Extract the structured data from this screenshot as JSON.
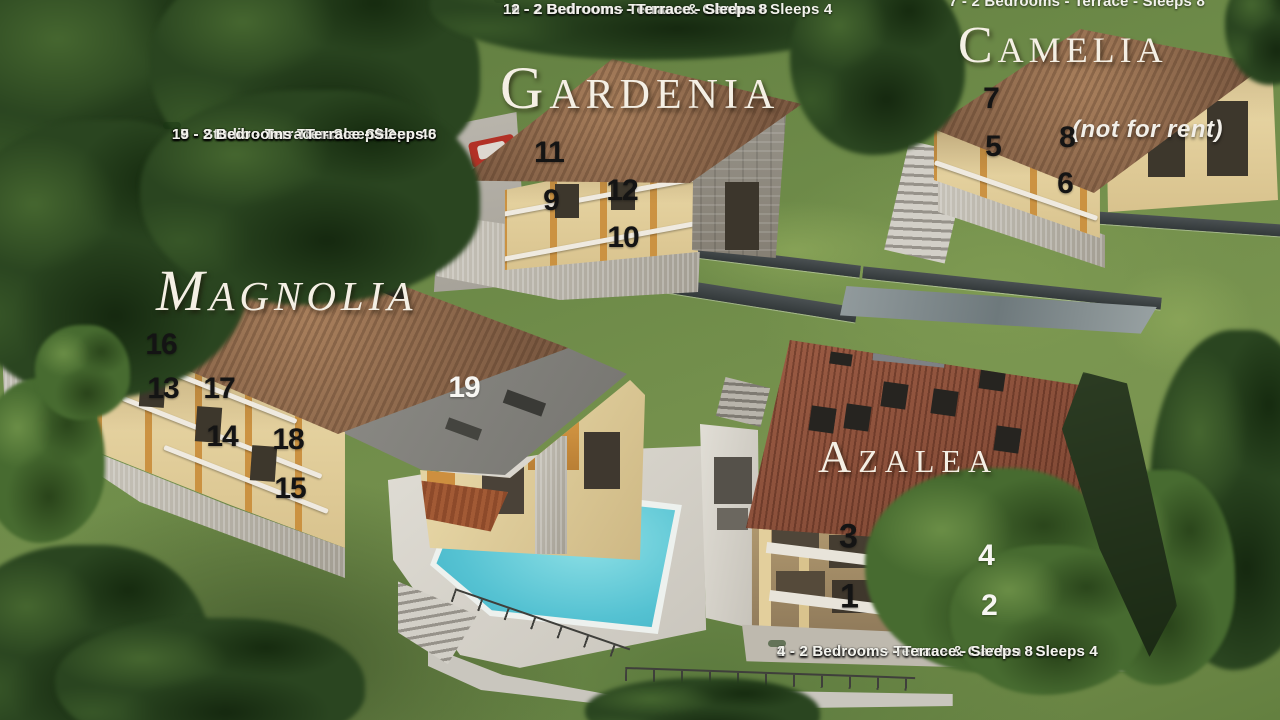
{
  "title": "Residence aerial site plan with apartment key",
  "palette": {
    "legend_text": "#f2f2ec",
    "marker_dark": "#141414",
    "marker_light": "#f7f6f2",
    "grass": "#6b8748",
    "trees": "#2a4520",
    "roof_brown": "#8a654c",
    "roof_terracotta": "#8f4f3a",
    "wall_cream": "#e7d6a4",
    "pool_water": "#57c3d2",
    "deck": "#d6d3cb",
    "stone_wall": "#9a958b"
  },
  "buildings": {
    "gardenia": {
      "name": "Gardenia",
      "legend": [
        "10 - 1 Bedroom - Terrace & Garden - Sleeps 4",
        "11 - 2 Bedrooms - Terrace - Sleeps 8",
        "12 - 2 Bedrooms - Terrace - Sleeps 8"
      ]
    },
    "camelia": {
      "name": "Camelia",
      "note": "(not for rent)",
      "legend": [
        "7 - 2 Bedrooms - Terrace - Sleeps 8"
      ]
    },
    "magnolia": {
      "name": "Magnolia",
      "legend": [
        "13 - 1 Bedroom - Terrace - Sleeps 4",
        "14 - 1 Bedroom - Terrace - Sleeps 4",
        "15 - 2 Bedrooms - Terrace - Sleeps 6",
        "16 - 2 Bedrooms - Terrace - Sleeps 8",
        "17 - 2 Bedrooms - Terrace - Sleeps 8",
        "18 - Studio - Terrace - Sleeps 2",
        "19 - 2 Bedrooms - Terrace - Sleeps 6"
      ]
    },
    "azalea": {
      "name": "Azalea",
      "legend": [
        "1 - 1 Bedroom - Terrace & Garden - Sleeps 4",
        "2 - 1 Bedroom - Terrace & Garden - Sleeps 4",
        "3 - 2 Bedrooms - Terrace - Sleeps 8",
        "4 - 2 Bedrooms - Terrace - Sleeps 8"
      ]
    }
  },
  "unit_markers": [
    {
      "label": "11",
      "building": "gardenia",
      "x": 549,
      "y": 153,
      "color": "#141414"
    },
    {
      "label": "9",
      "building": "gardenia",
      "x": 551,
      "y": 201,
      "color": "#141414"
    },
    {
      "label": "12",
      "building": "gardenia",
      "x": 622,
      "y": 191,
      "color": "#141414"
    },
    {
      "label": "10",
      "building": "gardenia",
      "x": 623,
      "y": 238,
      "color": "#141414"
    },
    {
      "label": "7",
      "building": "camelia",
      "x": 991,
      "y": 99,
      "color": "#141414"
    },
    {
      "label": "5",
      "building": "camelia",
      "x": 993,
      "y": 147,
      "color": "#141414"
    },
    {
      "label": "8",
      "building": "camelia",
      "x": 1067,
      "y": 138,
      "color": "#141414"
    },
    {
      "label": "6",
      "building": "camelia",
      "x": 1065,
      "y": 184,
      "color": "#141414"
    },
    {
      "label": "16",
      "building": "magnolia",
      "x": 161,
      "y": 345,
      "color": "#141414"
    },
    {
      "label": "13",
      "building": "magnolia",
      "x": 163,
      "y": 389,
      "color": "#141414"
    },
    {
      "label": "17",
      "building": "magnolia",
      "x": 219,
      "y": 389,
      "color": "#141414"
    },
    {
      "label": "14",
      "building": "magnolia",
      "x": 222,
      "y": 437,
      "color": "#141414"
    },
    {
      "label": "18",
      "building": "magnolia",
      "x": 288,
      "y": 440,
      "color": "#141414"
    },
    {
      "label": "15",
      "building": "magnolia",
      "x": 290,
      "y": 489,
      "color": "#141414"
    },
    {
      "label": "19",
      "building": "magnolia",
      "x": 464,
      "y": 388,
      "color": "#f7f6f2"
    },
    {
      "label": "3",
      "building": "azalea",
      "x": 848,
      "y": 537,
      "color": "#141414",
      "size": 34
    },
    {
      "label": "1",
      "building": "azalea",
      "x": 849,
      "y": 597,
      "color": "#141414",
      "size": 34
    },
    {
      "label": "4",
      "building": "azalea",
      "x": 986,
      "y": 556,
      "color": "#f7f6f2"
    },
    {
      "label": "2",
      "building": "azalea",
      "x": 989,
      "y": 606,
      "color": "#f7f6f2"
    }
  ]
}
